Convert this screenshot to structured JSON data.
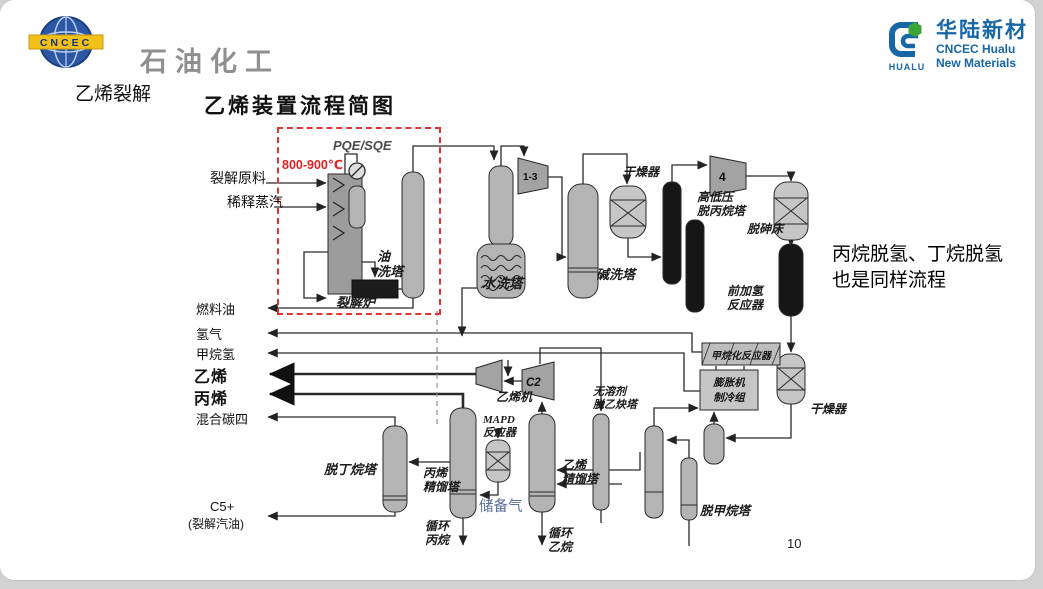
{
  "header": {
    "left_logo": {
      "mark_text": "CNCEC",
      "brand": "石油化工"
    },
    "right_logo": {
      "brand_cn": "华陆新材",
      "brand_en_line1": "CNCEC Hualu",
      "brand_en_line2": "New Materials",
      "mark_text": "HUALU"
    }
  },
  "slide": {
    "title": "乙烯裂解",
    "page_number": "10",
    "annotation": "丙烷脱氢、丁烷脱氢\n也是同样流程"
  },
  "diagram": {
    "title": "乙烯装置流程简图",
    "temperature": "800-900℃",
    "quench_exchanger": "PQE/SQE",
    "feeds": {
      "feed": "裂解原料",
      "steam": "稀释蒸汽"
    },
    "products": {
      "fuel_oil": "燃料油",
      "hydrogen": "氢气",
      "methane_hydrogen": "甲烷氢",
      "ethylene": "乙烯",
      "propylene": "丙烯",
      "mixed_c4": "混合碳四",
      "c5": "C5+",
      "c5_note": "(裂解汽油)"
    },
    "equipment": {
      "furnace": "裂解炉",
      "oil_wash": "油\n洗塔",
      "water_wash": "水洗塔",
      "caustic_wash": "碱洗塔",
      "dryer_top": "干燥器",
      "depropanizer": "高低压\n脱丙烷塔",
      "arsine_bed": "脱砷床",
      "front_hydrogenation": "前加氢\n反应器",
      "methanation_reactor": "甲烷化反应器",
      "expander_unit": "膨胀机\n制冷组",
      "dryer_right": "干燥器",
      "ethylene_compressor": "乙烯机",
      "mapd_reactor": "MAPD\n反应器",
      "debutanizer": "脱丁烷塔",
      "propylene_fractionator": "丙烯\n精馏塔",
      "reserve_gas": "储备气",
      "recycle_propane": "循环\n丙烷",
      "ethylene_fractionator": "乙烯\n精馏塔",
      "recycle_ethane": "循环\n乙烷",
      "deacetylene_tower": "无溶剂\n脱乙炔塔",
      "demethanizer": "脱甲烷塔"
    },
    "compressors": {
      "c13": "1-3",
      "c4": "4",
      "c2": "C2"
    },
    "colors": {
      "highlight_red": "#e23333",
      "reserve_gas_text": "#5b6e9e",
      "brand_blue": "#1766a6",
      "logo_yellow": "#f3c018"
    }
  }
}
